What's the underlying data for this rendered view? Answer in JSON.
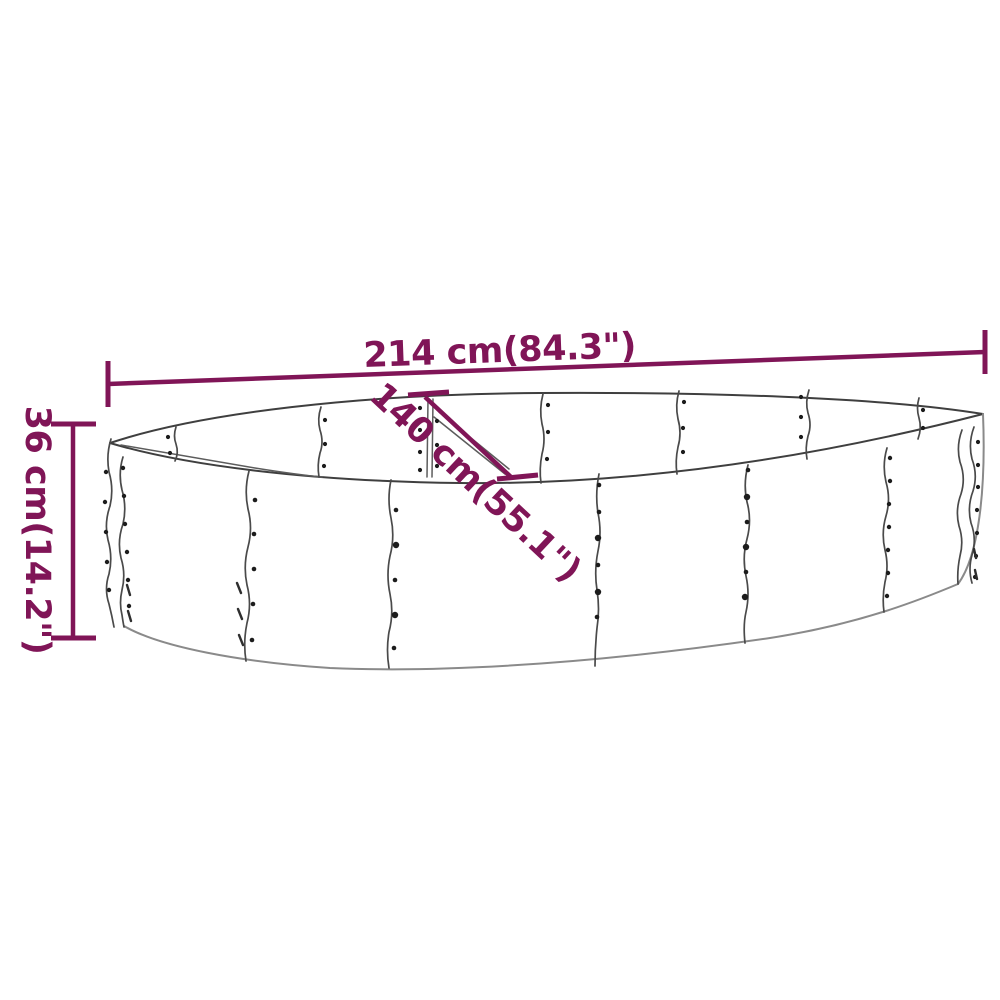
{
  "diagram": {
    "description": "Line drawing of an oval metal raised garden bed with riveted panels and three dimension annotations",
    "colors": {
      "accent": "#801557",
      "drawing_line": "#3f3f3f",
      "background": "#ffffff"
    },
    "dimensions": {
      "length_label": "214 cm(84.3\")",
      "height_label": "36 cm(14.2\")",
      "width_label": "140 cm(55.1\")"
    }
  }
}
